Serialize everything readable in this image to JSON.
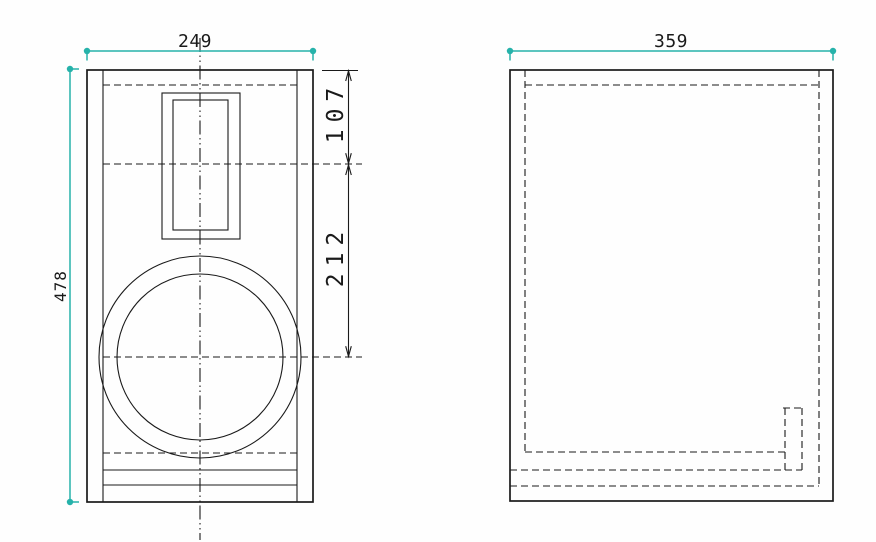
{
  "drawing": {
    "type": "technical-drawing-speaker-enclosure",
    "views": {
      "front": {
        "width_label": "249",
        "height_label": "478",
        "tweeter_center_offset_label": "107",
        "tweeter_to_woofer_label": "212"
      },
      "side": {
        "depth_label": "359"
      }
    },
    "colors": {
      "dimension_accent": "#26b2aa",
      "line_color": "#1a1a1a",
      "background": "#fefefe"
    },
    "icons": {
      "dimension_endpoint": "round-dot",
      "dimension_terminator": "open-arrowhead"
    }
  }
}
